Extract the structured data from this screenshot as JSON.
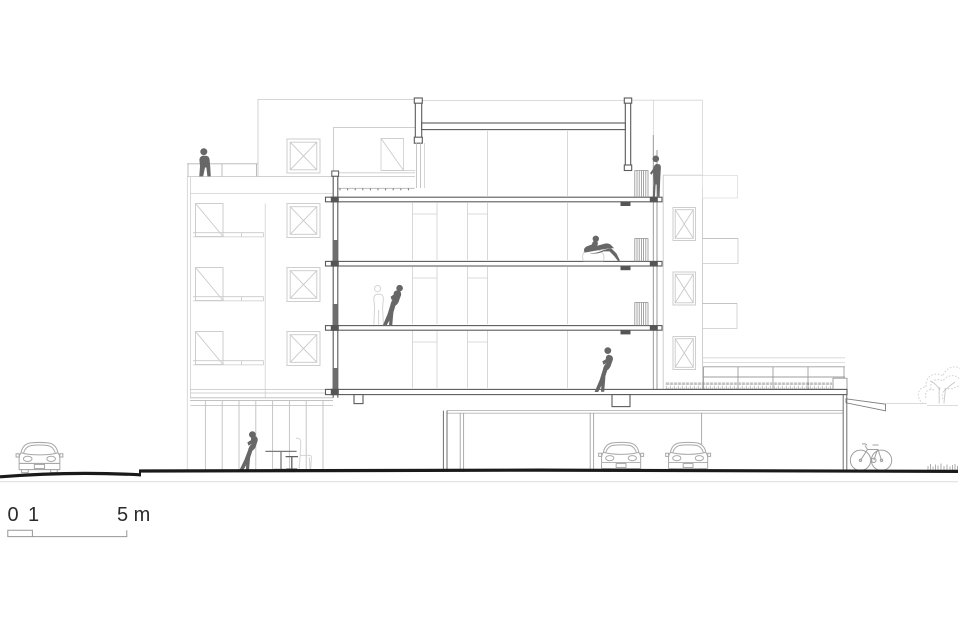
{
  "drawing": {
    "type": "architectural-cross-section",
    "scale_bar": {
      "zero": "0",
      "one": "1",
      "five_m": "5 m"
    },
    "colors": {
      "background": "#ffffff",
      "cut_line": "#5a5a5a",
      "light_line": "#c9c9c9",
      "medium_line": "#a8a8a8",
      "ground_line": "#1a1a1a",
      "figure": "#676767",
      "ghost_outline": "#d4d4d4",
      "vegetation": "#8e8e8e"
    },
    "elements": {
      "people": [
        "person-standing-roof-terrace-left",
        "person-standing-balcony-top-right",
        "person-reclining-third-floor",
        "person-leaning-second-floor",
        "person-leaning-first-floor",
        "person-standing-cafe-ground-floor"
      ],
      "vehicles": [
        "car-street-left",
        "car-garage-1",
        "car-garage-2",
        "bicycle-right"
      ],
      "vegetation": [
        "green-roof-planting",
        "tree-right",
        "grass-tufts-right"
      ],
      "furniture": [
        "cafe-table",
        "cafe-stool",
        "ghost-chair"
      ]
    }
  }
}
